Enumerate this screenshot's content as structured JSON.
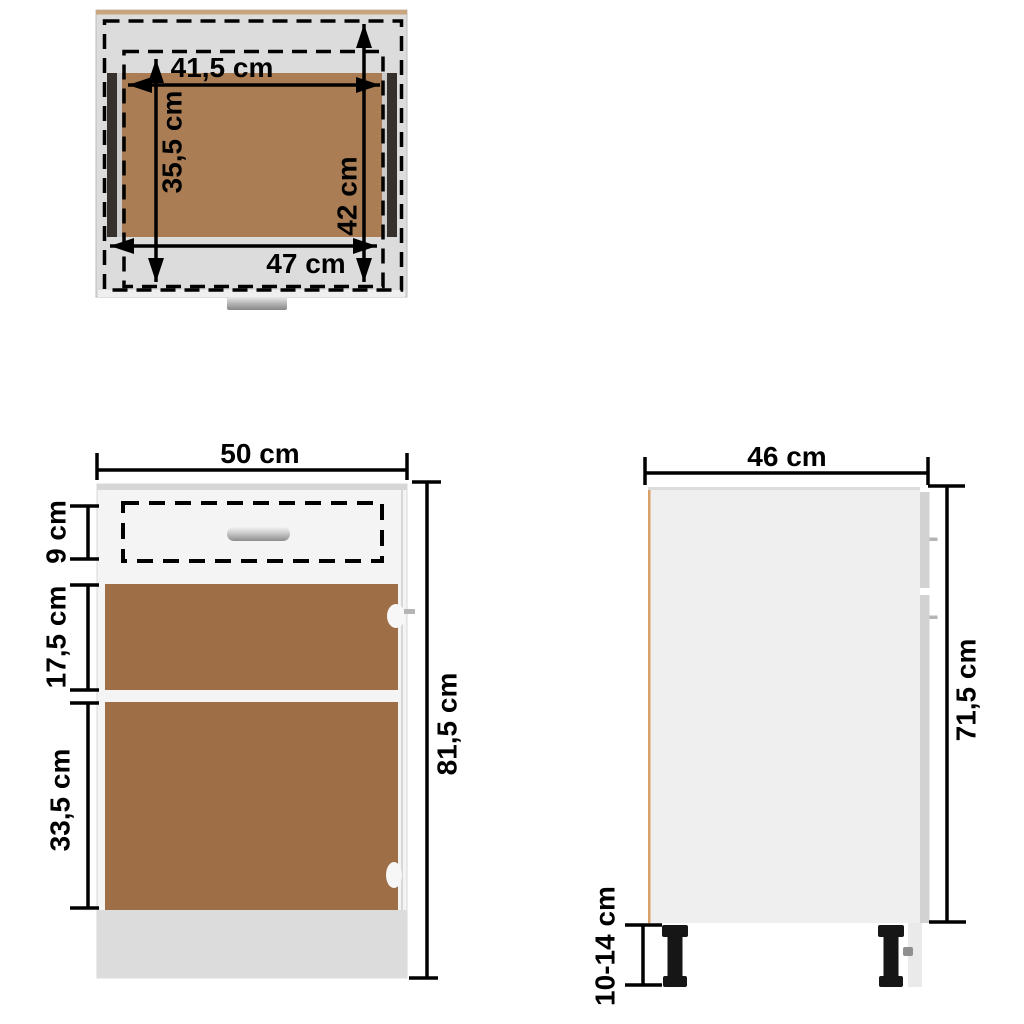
{
  "diagram": {
    "kind": "furniture-dimension-diagram",
    "subject": "drawer bottom cabinet technical drawing, three views",
    "colors": {
      "background": "#ffffff",
      "dimension_color": "#000000",
      "top_gray": "#dcdcdc",
      "top_bottom_strip": "#efefef",
      "edge_tan": "#c9a47c",
      "slide_black": "#35302b",
      "sliver_gray": "#cbcbcb",
      "panel_brown_top": "#aa7d55",
      "cabinet_body_gray": "#f4f4f4",
      "cabinet_top_strip": "#d6d6d6",
      "panel_brown_front": "#9e6e46",
      "plinth_gray": "#dcdcdc",
      "side_panel_gray": "#efefef",
      "side_top_strip": "#dcdcdc",
      "front_edge_gray": "#d2d2d2",
      "below_edge_gray": "#eaeaea",
      "back_edge_orange": "#d7a169",
      "leg_black": "#161616",
      "screw_gray": "#8f8f8f",
      "hinge_white": "#f7f7f7",
      "pin_gray": "#b5b5b5"
    },
    "views": {
      "top_view": {
        "name": "drawer top view",
        "labels": {
          "inner_width": "41,5 cm",
          "inner_depth": "35,5 cm",
          "slide_length": "42 cm",
          "outer_width": "47 cm"
        }
      },
      "front_view": {
        "name": "cabinet front view",
        "labels": {
          "width": "50 cm",
          "drawer_front_height": "9 cm",
          "upper_panel_height": "17,5 cm",
          "lower_panel_height": "33,5 cm",
          "total_height": "81,5 cm"
        }
      },
      "side_view": {
        "name": "cabinet side view",
        "labels": {
          "depth": "46 cm",
          "body_height": "71,5 cm",
          "leg_height": "10-14 cm"
        }
      }
    }
  }
}
